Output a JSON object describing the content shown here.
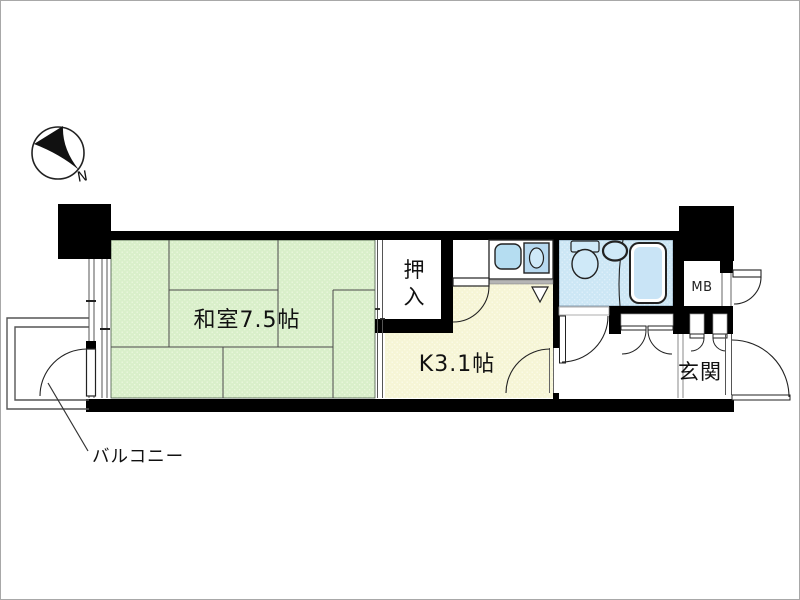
{
  "title": "apartment-floor-plan",
  "compass": {
    "north_label": "N"
  },
  "labels": {
    "washitsu": "和室7.5帖",
    "oshiire_line1": "押",
    "oshiire_line2": "入",
    "kitchen": "K3.1帖",
    "genkan": "玄関",
    "meter_box": "MB",
    "balcony": "バルコニー"
  },
  "colors": {
    "wall": "#000000",
    "tatami": "#d9efca",
    "tatami_dot": "#eef8e2",
    "kitchen_floor": "#f6f5d6",
    "kitchen_dot": "#fdfcee",
    "bathroom_floor": "#cde7f5",
    "bathroom_dot": "#e4f2fb",
    "fixture": "#cfe9f8",
    "tub": "#c9e4f6",
    "sink": "#b5ddf1",
    "stove": "#b7d9f0",
    "line": "#222222"
  }
}
